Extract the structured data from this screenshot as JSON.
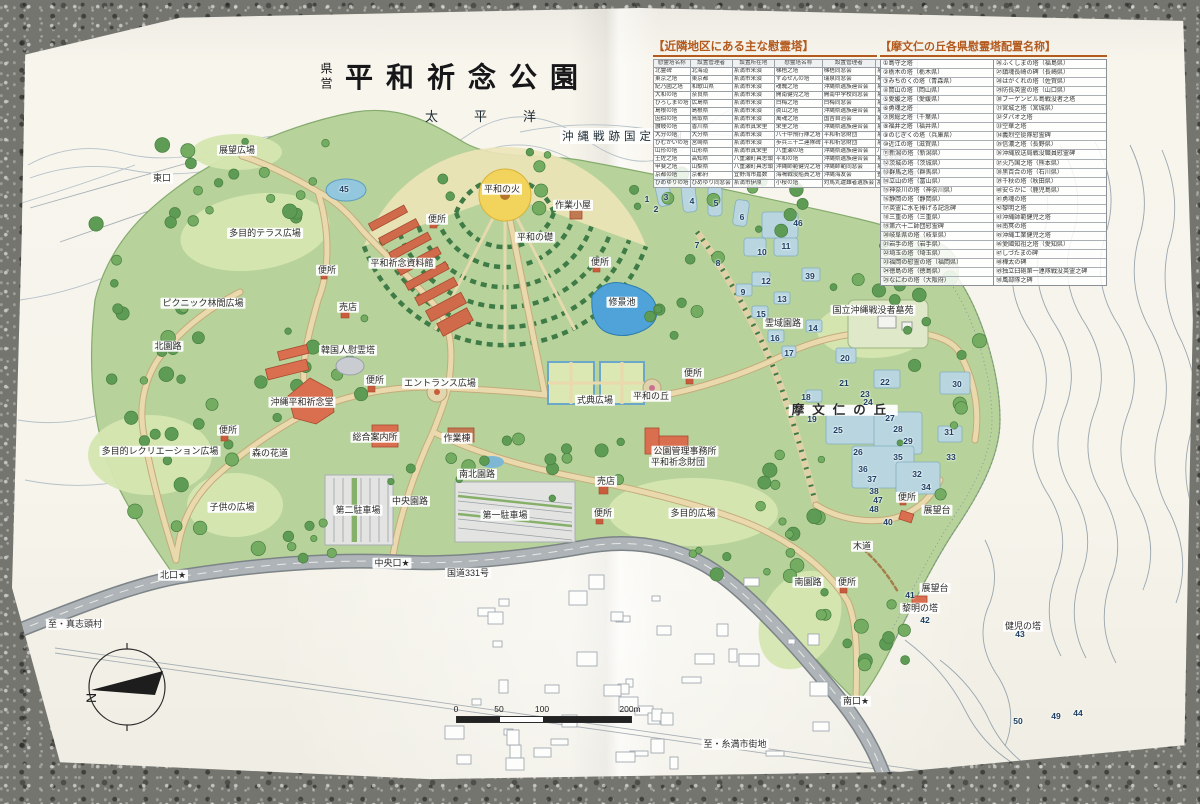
{
  "title": {
    "prefix": "県営",
    "main": "平和祈念公園"
  },
  "labels_static": {
    "sea": "太平洋",
    "quasi_park": "沖縄戦跡国定公園"
  },
  "legend_neighbor": {
    "title": "【近隣地区にある主な慰霊塔】",
    "columns": [
      "慰霊塔名称",
      "設置管理者",
      "設置所在地",
      "慰霊塔名称",
      "設置管理者",
      "設置所在地"
    ],
    "rows": [
      [
        "北霊碑",
        "北海道",
        "糸満市米須",
        "梯梧之塔",
        "梯梧同窓会",
        "糸満市米須"
      ],
      [
        "東京之塔",
        "東京都",
        "糸満市米須",
        "ずゐせんの塔",
        "瑞泉同窓会",
        "糸満市米須"
      ],
      [
        "紀乃國之塔",
        "和歌山県",
        "糸満市米須",
        "魂魄之塔",
        "沖縄県遺族連合会",
        "糸満市米須"
      ],
      [
        "大和の塔",
        "奈良県",
        "糸満市米須",
        "開南健児之塔",
        "開南中学校同窓会",
        "糸満市米須"
      ],
      [
        "ひろしまの塔",
        "広島県",
        "糸満市米須",
        "白梅之塔",
        "白梅同窓会",
        "糸満市国吉"
      ],
      [
        "島根の塔",
        "島根県",
        "糸満市米須",
        "眞山之塔",
        "沖縄県遺族連合会",
        "糸満市真栄里"
      ],
      [
        "因伯の塔",
        "鳥取県",
        "糸満市米須",
        "萬魂之塔",
        "国吉自治会",
        "糸満市国吉"
      ],
      [
        "讃岐の塔",
        "香川県",
        "糸満市真栄里",
        "栄里之塔",
        "沖縄県遺族連合会",
        "糸満市真栄里"
      ],
      [
        "大分の塔",
        "大分県",
        "糸満市米須",
        "八十中飛行隊之塔",
        "平和祈念財団",
        "糸満市真栄里"
      ],
      [
        "ひむかいの塔",
        "宮崎県",
        "糸満市米須",
        "歩兵三十二連隊碑",
        "平和祈念財団",
        "糸満市真栄里"
      ],
      [
        "山形の塔",
        "山形県",
        "糸満市真栄里",
        "八重瀬の塔",
        "沖縄県遺族連合会",
        "八重瀬町富盛"
      ],
      [
        "土佐之塔",
        "高知県",
        "八重瀬町具志頭",
        "平和の塔",
        "沖縄県遺族連合会",
        "糸満市喜屋武"
      ],
      [
        "甲斐之塔",
        "山梨県",
        "八重瀬町具志頭",
        "沖縄師範健児之塔",
        "沖縄師範同窓会",
        "糸満市山城"
      ],
      [
        "京都の塔",
        "京都府",
        "宜野湾市嘉数",
        "海鳴戦没船員之塔",
        "沖縄海友会",
        "豊見城市豊見城"
      ],
      [
        "ひめゆりの塔",
        "ひめゆり同窓会",
        "糸満市伊原",
        "小桜の塔",
        "対馬丸遭難者遺族会",
        "那覇市若狭"
      ]
    ]
  },
  "legend_mabuni": {
    "title": "【摩文仁の丘各県慰霊塔配置名称】",
    "entries_left": [
      "①島守之塔",
      "②栃木の塔（栃木県）",
      "③みちのくの塔（青森県）",
      "④岡山の塔（岡山県）",
      "⑤愛媛之塔（愛媛県）",
      "⑥勇魂之塔",
      "⑦房総之塔（千葉県）",
      "⑧福井之塔（福井県）",
      "⑨のじぎくの塔（兵庫県）",
      "⑩近江の塔（滋賀県）",
      "⑪新潟の塔（新潟県）",
      "⑫茨城の塔（茨城県）",
      "⑬群馬之塔（群馬県）",
      "⑭立山の塔（富山県）",
      "⑮神奈川の塔（神奈川県）",
      "⑯静岡の塔（静岡県）",
      "⑰英霊に水を捧げる記念碑",
      "⑱三重の塔（三重県）",
      "⑲第六十二師団慰霊碑",
      "⑳岐阜県の塔（岐阜県）",
      "㉑岩手の塔（岩手県）",
      "㉒埼玉の塔（埼玉県）",
      "㉓福岡の慰霊の塔（福岡県）",
      "㉔徳島の塔（徳島県）",
      "㉕なにわの塔（大阪府）"
    ],
    "entries_right": [
      "㉖ふくしまの塔（福島県）",
      "㉗鎮魂長崎の碑（長崎県）",
      "㉘はがくれの塔（佐賀県）",
      "㉙防長英霊の塔（山口県）",
      "㉚ブーゲンビル島戦没者之塔",
      "㉛宮城之塔（宮城県）",
      "㉜ダバオ之塔",
      "㉝空華之塔",
      "㉞義烈空挺隊慰霊碑",
      "㉟信濃之塔（長野県）",
      "㊱沖縄放送局戦没職員慰霊碑",
      "㊲火乃国之塔（熊本県）",
      "㊳黒百合の塔（石川県）",
      "㊴千秋の塔（秋田県）",
      "㊵安らかに（鹿児島県）",
      "㊶勇魂の塔",
      "㊷黎明之塔",
      "㊸沖縄師範健児之塔",
      "㊹南冥の塔",
      "㊺沖縄工業健児之塔",
      "㊻愛國知祖之塔（愛知県）",
      "㊼しづたまの碑",
      "㊽樺太の碑",
      "㊾独立臼砲第一連隊戦没英霊之碑",
      "㊿風部隊之碑"
    ]
  },
  "map_labels": [
    {
      "t": "展望広場",
      "x": 237,
      "y": 150
    },
    {
      "t": "東口",
      "x": 162,
      "y": 178
    },
    {
      "t": "多目的テラス広場",
      "x": 265,
      "y": 233
    },
    {
      "t": "便所",
      "x": 327,
      "y": 270
    },
    {
      "t": "ピクニック林間広場",
      "x": 203,
      "y": 303
    },
    {
      "t": "北園路",
      "x": 168,
      "y": 346
    },
    {
      "t": "便所",
      "x": 437,
      "y": 219
    },
    {
      "t": "平和の火",
      "x": 502,
      "y": 189
    },
    {
      "t": "作業小屋",
      "x": 573,
      "y": 205
    },
    {
      "t": "平和の礎",
      "x": 535,
      "y": 237
    },
    {
      "t": "平和祈念資料館",
      "x": 402,
      "y": 263
    },
    {
      "t": "便所",
      "x": 600,
      "y": 262
    },
    {
      "t": "修景池",
      "x": 622,
      "y": 302
    },
    {
      "t": "売店",
      "x": 348,
      "y": 307
    },
    {
      "t": "韓国人慰霊塔",
      "x": 348,
      "y": 350
    },
    {
      "t": "便所",
      "x": 375,
      "y": 380
    },
    {
      "t": "エントランス広場",
      "x": 440,
      "y": 383
    },
    {
      "t": "沖縄平和祈念堂",
      "x": 302,
      "y": 402
    },
    {
      "t": "総合案内所",
      "x": 375,
      "y": 437
    },
    {
      "t": "作業棟",
      "x": 457,
      "y": 438
    },
    {
      "t": "便所",
      "x": 228,
      "y": 430
    },
    {
      "t": "多目的レクリエーション広場",
      "x": 160,
      "y": 451
    },
    {
      "t": "森の花道",
      "x": 270,
      "y": 453
    },
    {
      "t": "南北園路",
      "x": 477,
      "y": 474
    },
    {
      "t": "式典広場",
      "x": 595,
      "y": 400
    },
    {
      "t": "平和の丘",
      "x": 651,
      "y": 396
    },
    {
      "t": "便所",
      "x": 693,
      "y": 373
    },
    {
      "t": "公園管理事務所",
      "x": 685,
      "y": 451
    },
    {
      "t": "平和祈念財団",
      "x": 678,
      "y": 462
    },
    {
      "t": "売店",
      "x": 606,
      "y": 481
    },
    {
      "t": "便所",
      "x": 603,
      "y": 513
    },
    {
      "t": "多目的広場",
      "x": 693,
      "y": 513
    },
    {
      "t": "子供の広場",
      "x": 232,
      "y": 507
    },
    {
      "t": "第二駐車場",
      "x": 358,
      "y": 510
    },
    {
      "t": "中央園路",
      "x": 410,
      "y": 501
    },
    {
      "t": "第一駐車場",
      "x": 505,
      "y": 515
    },
    {
      "t": "中央口★",
      "x": 392,
      "y": 563
    },
    {
      "t": "北口★",
      "x": 173,
      "y": 575
    },
    {
      "t": "至・真志頭村",
      "x": 75,
      "y": 624
    },
    {
      "t": "国道331号",
      "x": 468,
      "y": 573
    },
    {
      "t": "霊域園路",
      "x": 783,
      "y": 323
    },
    {
      "t": "国立沖縄戦没者墓苑",
      "x": 873,
      "y": 310
    },
    {
      "t": "摩文仁の丘",
      "x": 843,
      "y": 410,
      "cls": "big"
    },
    {
      "t": "便所",
      "x": 907,
      "y": 497
    },
    {
      "t": "展望台",
      "x": 937,
      "y": 510
    },
    {
      "t": "木道",
      "x": 862,
      "y": 546
    },
    {
      "t": "南園路",
      "x": 808,
      "y": 582
    },
    {
      "t": "便所",
      "x": 847,
      "y": 582
    },
    {
      "t": "展望台",
      "x": 935,
      "y": 588
    },
    {
      "t": "黎明の塔",
      "x": 920,
      "y": 608
    },
    {
      "t": "健児の塔",
      "x": 1023,
      "y": 626
    },
    {
      "t": "南口★",
      "x": 856,
      "y": 701
    },
    {
      "t": "至・糸満市街地",
      "x": 735,
      "y": 744
    }
  ],
  "markers": [
    {
      "n": "1",
      "x": 647,
      "y": 199
    },
    {
      "n": "2",
      "x": 656,
      "y": 209
    },
    {
      "n": "3",
      "x": 666,
      "y": 197
    },
    {
      "n": "4",
      "x": 692,
      "y": 201
    },
    {
      "n": "5",
      "x": 716,
      "y": 203
    },
    {
      "n": "6",
      "x": 742,
      "y": 217
    },
    {
      "n": "7",
      "x": 697,
      "y": 245
    },
    {
      "n": "8",
      "x": 718,
      "y": 263
    },
    {
      "n": "9",
      "x": 743,
      "y": 292
    },
    {
      "n": "10",
      "x": 762,
      "y": 252
    },
    {
      "n": "11",
      "x": 786,
      "y": 246
    },
    {
      "n": "12",
      "x": 766,
      "y": 281
    },
    {
      "n": "13",
      "x": 782,
      "y": 299
    },
    {
      "n": "14",
      "x": 813,
      "y": 328
    },
    {
      "n": "15",
      "x": 761,
      "y": 314
    },
    {
      "n": "16",
      "x": 775,
      "y": 338
    },
    {
      "n": "17",
      "x": 789,
      "y": 353
    },
    {
      "n": "18",
      "x": 806,
      "y": 397
    },
    {
      "n": "19",
      "x": 812,
      "y": 419
    },
    {
      "n": "20",
      "x": 845,
      "y": 358
    },
    {
      "n": "21",
      "x": 844,
      "y": 383
    },
    {
      "n": "22",
      "x": 885,
      "y": 382
    },
    {
      "n": "23",
      "x": 865,
      "y": 394
    },
    {
      "n": "24",
      "x": 868,
      "y": 402
    },
    {
      "n": "25",
      "x": 838,
      "y": 430
    },
    {
      "n": "26",
      "x": 858,
      "y": 452
    },
    {
      "n": "27",
      "x": 890,
      "y": 418
    },
    {
      "n": "28",
      "x": 898,
      "y": 429
    },
    {
      "n": "29",
      "x": 908,
      "y": 441
    },
    {
      "n": "30",
      "x": 957,
      "y": 384
    },
    {
      "n": "31",
      "x": 949,
      "y": 432
    },
    {
      "n": "32",
      "x": 917,
      "y": 474
    },
    {
      "n": "33",
      "x": 951,
      "y": 457
    },
    {
      "n": "34",
      "x": 926,
      "y": 487
    },
    {
      "n": "35",
      "x": 898,
      "y": 457
    },
    {
      "n": "36",
      "x": 863,
      "y": 469
    },
    {
      "n": "37",
      "x": 872,
      "y": 479
    },
    {
      "n": "38",
      "x": 874,
      "y": 491
    },
    {
      "n": "39",
      "x": 810,
      "y": 276
    },
    {
      "n": "40",
      "x": 888,
      "y": 522
    },
    {
      "n": "41",
      "x": 910,
      "y": 595
    },
    {
      "n": "42",
      "x": 925,
      "y": 620
    },
    {
      "n": "43",
      "x": 1020,
      "y": 634
    },
    {
      "n": "44",
      "x": 1078,
      "y": 713
    },
    {
      "n": "45",
      "x": 344,
      "y": 189
    },
    {
      "n": "46",
      "x": 798,
      "y": 223
    },
    {
      "n": "47",
      "x": 878,
      "y": 500
    },
    {
      "n": "48",
      "x": 874,
      "y": 509
    },
    {
      "n": "49",
      "x": 1056,
      "y": 716
    },
    {
      "n": "50",
      "x": 1018,
      "y": 721
    }
  ],
  "compass": {
    "north_label": "N"
  },
  "scale_bar": {
    "ticks": [
      "0",
      "50",
      "100",
      "200m"
    ]
  },
  "colors": {
    "paper": "#f6f4eb",
    "park_green": "#b7d29a",
    "lawn_green": "#d5e6b2",
    "tree_green": "#5e9c55",
    "path_beige": "#ead9ad",
    "road_gray": "#aeb4b7",
    "water_blue": "#4fa3d8",
    "building_red": "#d96f4e",
    "monument_blue": "#b9d6e0",
    "flame_yellow": "#f2d45c",
    "legend_title_orange": "#b35a1f",
    "marker_navy": "#1d3f63"
  }
}
